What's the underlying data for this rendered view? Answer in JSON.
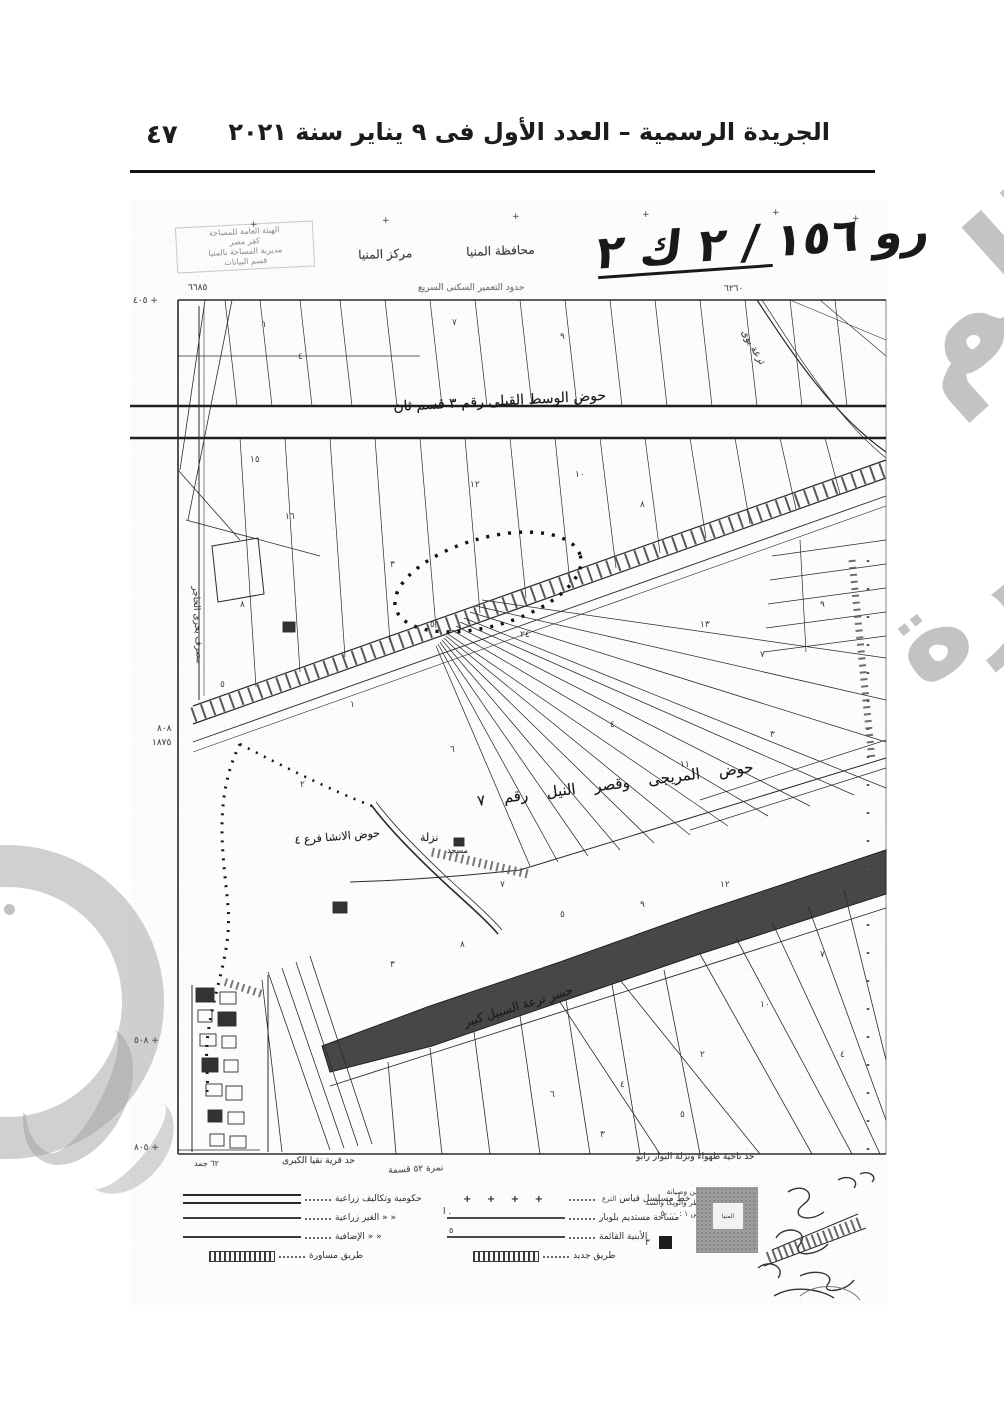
{
  "page": {
    "number": "٤٧",
    "header_title": "الجريدة الرسمية – العدد الأول فى ٩ يناير سنة ٢٠٢١"
  },
  "colors": {
    "ink": "#1c1c1c",
    "scan_background": "#fcfcfb",
    "canal_fill": "#474747",
    "watermark_gray": "#9b9b9b",
    "stamp_gray": "#9c9c9c"
  },
  "map": {
    "sheet_title": "رو ١٥٦ / ٢ ك ٢",
    "corner_note_lines": [
      "الهيئة العامة للمساحة",
      "كفر مصر",
      "مديرية المساحة بالمنيا",
      "قسم البيانات"
    ],
    "labels": [
      {
        "name": "markaz-label",
        "t": "مركز المنيا",
        "x": 358,
        "y": 248,
        "s": 12,
        "r": -2,
        "c": "#3d3d3d"
      },
      {
        "name": "governorate-label",
        "t": "محافظة المنيا",
        "x": 466,
        "y": 245,
        "s": 12,
        "r": -2,
        "c": "#3d3d3d"
      },
      {
        "name": "survey-note-label",
        "t": "حدود التعمير السكنى السريع",
        "x": 418,
        "y": 283,
        "s": 9,
        "r": 0,
        "c": "#7a7a7a"
      },
      {
        "name": "hawd-wasat-label",
        "t": "حوض الوسط القبلى رقم ٣ قسم ثان",
        "x": 393,
        "y": 399,
        "s": 14,
        "r": -3,
        "c": "#181818"
      },
      {
        "name": "hawd-mureigi-label",
        "t": "حوض المريجى وقصر النيل رقم ٧",
        "x": 476,
        "y": 792,
        "s": 15,
        "r": -7,
        "c": "#181818",
        "ws": 14
      },
      {
        "name": "hawd-insha-label",
        "t": "حوض الانشا فرع ٤",
        "x": 294,
        "y": 834,
        "s": 11,
        "r": -5,
        "c": "#222"
      },
      {
        "name": "nazla-label",
        "t": "نزلة",
        "x": 420,
        "y": 831,
        "s": 11,
        "r": 0,
        "c": "#222"
      },
      {
        "name": "mosque-label",
        "t": "مسجد",
        "x": 447,
        "y": 846,
        "s": 8,
        "r": 0,
        "c": "#333"
      },
      {
        "name": "canal-label",
        "t": "جسر ترعة السبيل كبير",
        "x": 462,
        "y": 1016,
        "s": 12,
        "r": -17,
        "c": "#1d1d1d"
      },
      {
        "name": "masraf-label",
        "t": "مصرف بحرى الحاجر",
        "x": 200,
        "y": 586,
        "s": 9,
        "r": 87,
        "c": "#444"
      },
      {
        "name": "tira-buy-label",
        "t": "ترعة بوى",
        "x": 748,
        "y": 328,
        "s": 10,
        "r": 60,
        "c": "#444"
      },
      {
        "name": "num-6685",
        "t": "٦٦٨٥",
        "x": 188,
        "y": 283,
        "s": 9,
        "r": 0,
        "c": "#555"
      },
      {
        "name": "num-6260",
        "t": "٦٢٦٠",
        "x": 724,
        "y": 284,
        "s": 9,
        "r": 0,
        "c": "#555"
      },
      {
        "name": "num-405",
        "t": "+ ٤٠٥",
        "x": 133,
        "y": 296,
        "s": 9,
        "r": 0,
        "c": "#555"
      },
      {
        "name": "num-808",
        "t": "٨٠٨",
        "x": 157,
        "y": 724,
        "s": 9,
        "r": 0,
        "c": "#555"
      },
      {
        "name": "num-1875",
        "t": "١٨٧٥",
        "x": 152,
        "y": 738,
        "s": 9,
        "r": 0,
        "c": "#555"
      },
      {
        "name": "num-508",
        "t": "+ ٥٠٨",
        "x": 134,
        "y": 1036,
        "s": 9,
        "r": 0,
        "c": "#555"
      },
      {
        "name": "num-805",
        "t": "+ ٨٠٥",
        "x": 134,
        "y": 1143,
        "s": 9,
        "r": 0,
        "c": "#555"
      },
      {
        "name": "num-62-note",
        "t": "٦٢ جمد",
        "x": 194,
        "y": 1159,
        "s": 8,
        "r": 0,
        "c": "#555"
      },
      {
        "name": "village-note-left",
        "t": "حد قرية نقيا الكبرى",
        "x": 282,
        "y": 1156,
        "s": 9,
        "r": 0,
        "c": "#444"
      },
      {
        "name": "village-note-mid",
        "t": "نمرة ٥٢ قسمة",
        "x": 388,
        "y": 1166,
        "s": 9,
        "r": -3,
        "c": "#555"
      },
      {
        "name": "village-note-right",
        "t": "حد ناحية طهواء ونزلة البوار رابو",
        "x": 636,
        "y": 1152,
        "s": 9,
        "r": 0,
        "c": "#444"
      }
    ],
    "scatter_numbers": [
      {
        "t": "+",
        "x": 250,
        "y": 220
      },
      {
        "t": "+",
        "x": 382,
        "y": 216
      },
      {
        "t": "+",
        "x": 512,
        "y": 212
      },
      {
        "t": "+",
        "x": 642,
        "y": 210
      },
      {
        "t": "+",
        "x": 772,
        "y": 208
      },
      {
        "t": "+",
        "x": 852,
        "y": 214
      },
      {
        "t": "١",
        "x": 262,
        "y": 320
      },
      {
        "t": "٤",
        "x": 298,
        "y": 352
      },
      {
        "t": "٧",
        "x": 452,
        "y": 318
      },
      {
        "t": "٩",
        "x": 560,
        "y": 332
      },
      {
        "t": "١٥",
        "x": 250,
        "y": 455
      },
      {
        "t": "١٦",
        "x": 285,
        "y": 512
      },
      {
        "t": "١٢",
        "x": 470,
        "y": 480
      },
      {
        "t": "١٠",
        "x": 575,
        "y": 470
      },
      {
        "t": "٨",
        "x": 640,
        "y": 500
      },
      {
        "t": "٣",
        "x": 390,
        "y": 560
      },
      {
        "t": "٥",
        "x": 430,
        "y": 620
      },
      {
        "t": "٢٤",
        "x": 520,
        "y": 630
      },
      {
        "t": "١٣",
        "x": 700,
        "y": 620
      },
      {
        "t": "٧",
        "x": 760,
        "y": 650
      },
      {
        "t": "٩",
        "x": 820,
        "y": 600
      },
      {
        "t": "١",
        "x": 350,
        "y": 700
      },
      {
        "t": "٦",
        "x": 450,
        "y": 745
      },
      {
        "t": "٤",
        "x": 610,
        "y": 720
      },
      {
        "t": "١١",
        "x": 680,
        "y": 760
      },
      {
        "t": "٣",
        "x": 770,
        "y": 730
      },
      {
        "t": "٢",
        "x": 300,
        "y": 780
      },
      {
        "t": "٧",
        "x": 500,
        "y": 880
      },
      {
        "t": "٥",
        "x": 560,
        "y": 910
      },
      {
        "t": "٩",
        "x": 640,
        "y": 900
      },
      {
        "t": "١٢",
        "x": 720,
        "y": 880
      },
      {
        "t": "٨",
        "x": 460,
        "y": 940
      },
      {
        "t": "٣",
        "x": 390,
        "y": 960
      },
      {
        "t": "٦",
        "x": 550,
        "y": 1090
      },
      {
        "t": "٤",
        "x": 620,
        "y": 1080
      },
      {
        "t": "٢",
        "x": 700,
        "y": 1050
      },
      {
        "t": "١٠",
        "x": 760,
        "y": 1000
      },
      {
        "t": "٥",
        "x": 680,
        "y": 1110
      },
      {
        "t": "٣",
        "x": 600,
        "y": 1130
      },
      {
        "t": "٧",
        "x": 820,
        "y": 950
      },
      {
        "t": "٤",
        "x": 840,
        "y": 1050
      },
      {
        "t": "٨",
        "x": 240,
        "y": 600
      },
      {
        "t": "٥",
        "x": 220,
        "y": 680
      }
    ]
  },
  "legend": {
    "left_rows": [
      {
        "sample": "double",
        "label": "حكومية وتكاليف زراعية"
      },
      {
        "sample": "single",
        "label": "« «  الغير زراعية"
      },
      {
        "sample": "single",
        "label": "« «  الإضافية"
      },
      {
        "sample": "hatch",
        "label": "طريق مساورة"
      }
    ],
    "middle_rows": [
      {
        "sample": "crosses",
        "crosses": "+ + + +",
        "label": "خط مسلسل قياس",
        "extra": "الترع"
      },
      {
        "sample": "dotline",
        "label": "مساحة مستديم بلوبار"
      },
      {
        "sample": "dot",
        "label": "الأبنية القائمة"
      },
      {
        "sample": "hatch",
        "label": "طريق جديد"
      }
    ],
    "note_lines": [
      "حد فين وصيانة",
      "القناطر والويكا والسد",
      "مقياس ١ : ٥٠٠٠",
      "فـولة"
    ],
    "square_mark": "٣"
  },
  "stamp": {
    "inner_text": "المنيا"
  },
  "watermark": {
    "right_top": "الم",
    "right_mid": "صورة"
  }
}
